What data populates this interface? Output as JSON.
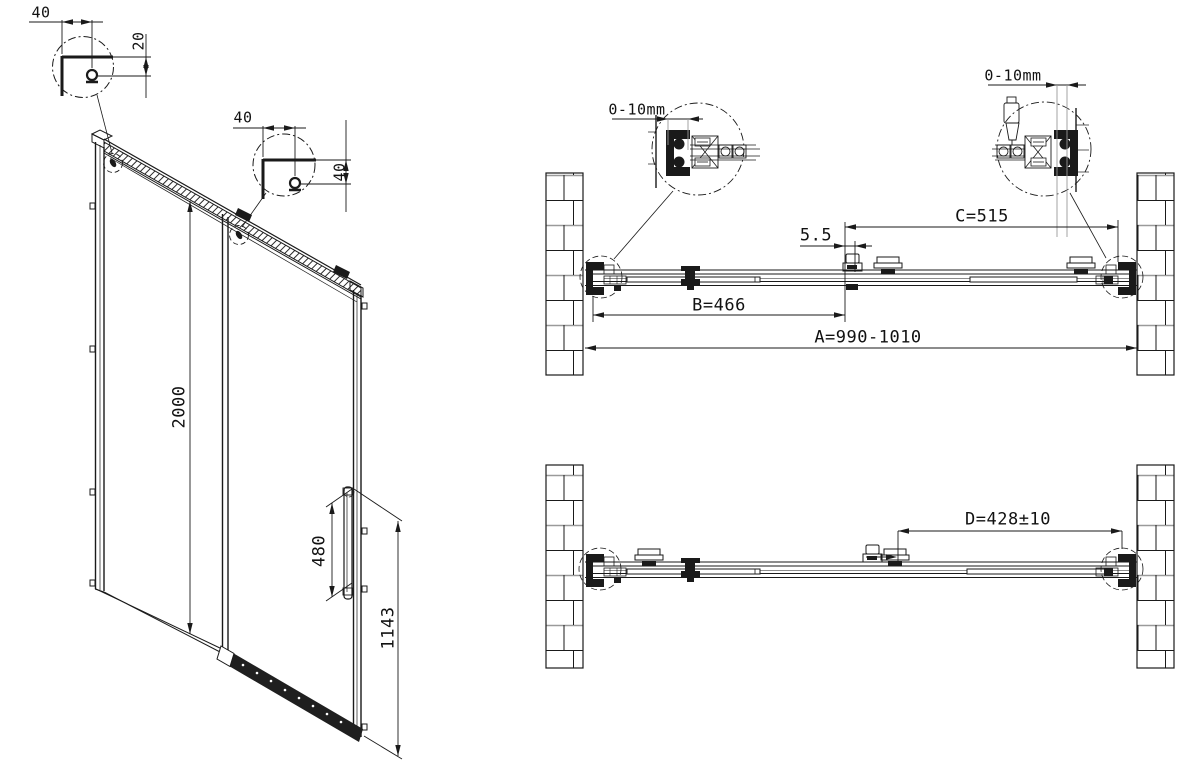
{
  "drawing": {
    "front_view": {
      "detail_top": {
        "width_dim": "40",
        "offset_dim": "20"
      },
      "detail_mid": {
        "width_dim": "40",
        "offset_dim": "40"
      },
      "door_height_dim": "2000",
      "handle_length_dim": "480",
      "handle_height_dim": "1143"
    },
    "plan_view_closed": {
      "wall_adjust_left": "0-10mm",
      "wall_adjust_right": "0-10mm",
      "panel_overlap_dim": "5.5",
      "fixed_panel_dim": "B=466",
      "sliding_panel_dim": "C=515",
      "overall_width_dim": "A=990-1010"
    },
    "plan_view_open": {
      "opening_dim": "D=428±10"
    }
  }
}
